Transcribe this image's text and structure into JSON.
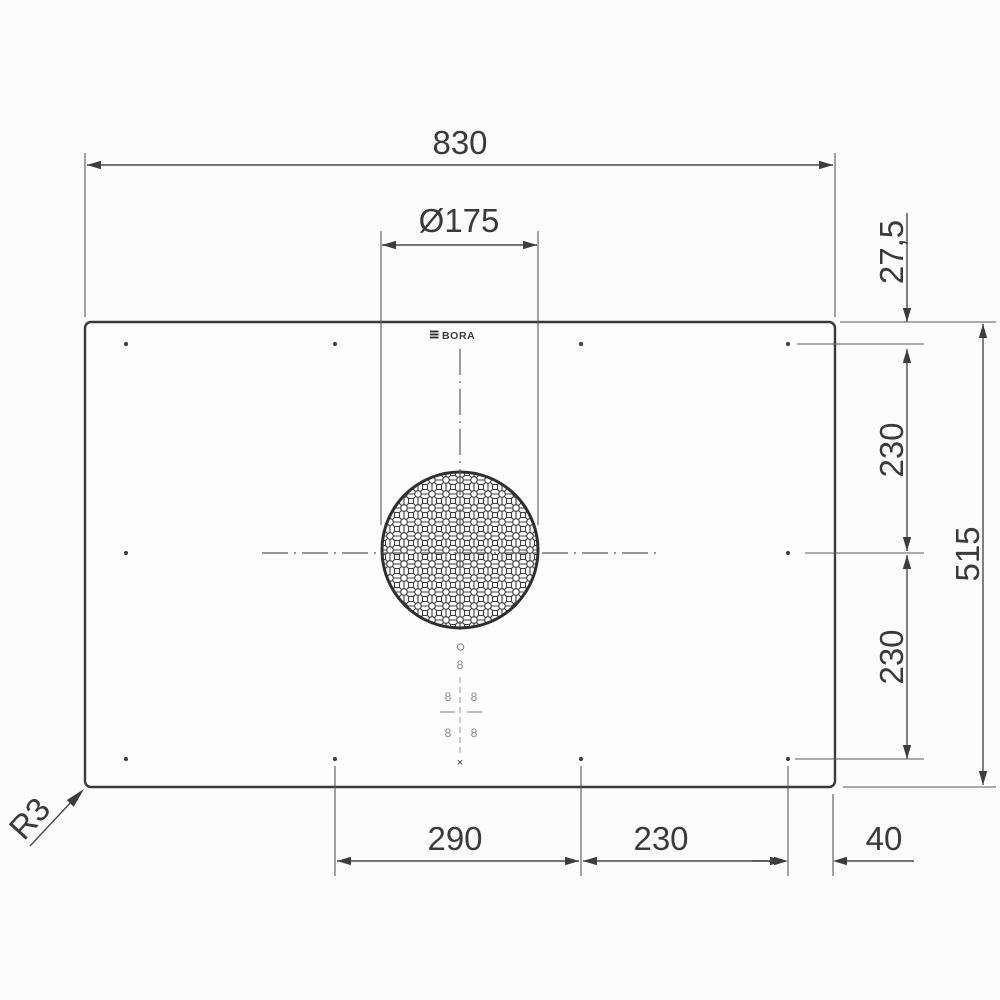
{
  "drawing": {
    "title": "Cooktop top view with installation dimensions",
    "brand_logo": "BORA",
    "units": "mm",
    "dims": {
      "total_width": "830",
      "duct_diameter": "Ø175",
      "edge_to_zone_top": "27,5",
      "zone_top_to_center": "230",
      "center_to_zone_bottom": "230",
      "total_depth": "515",
      "zone_span_left": "290",
      "zone_span_right": "230",
      "zone_to_edge": "40",
      "corner_radius": "R3"
    },
    "controls": {
      "digit": "8",
      "cross_marker": "×"
    },
    "colors": {
      "line": "#4a4a4a",
      "outline": "#383838",
      "text": "#3a3a3a",
      "control_gray": "#8a8a8a",
      "background": "#fcfcfc"
    }
  }
}
